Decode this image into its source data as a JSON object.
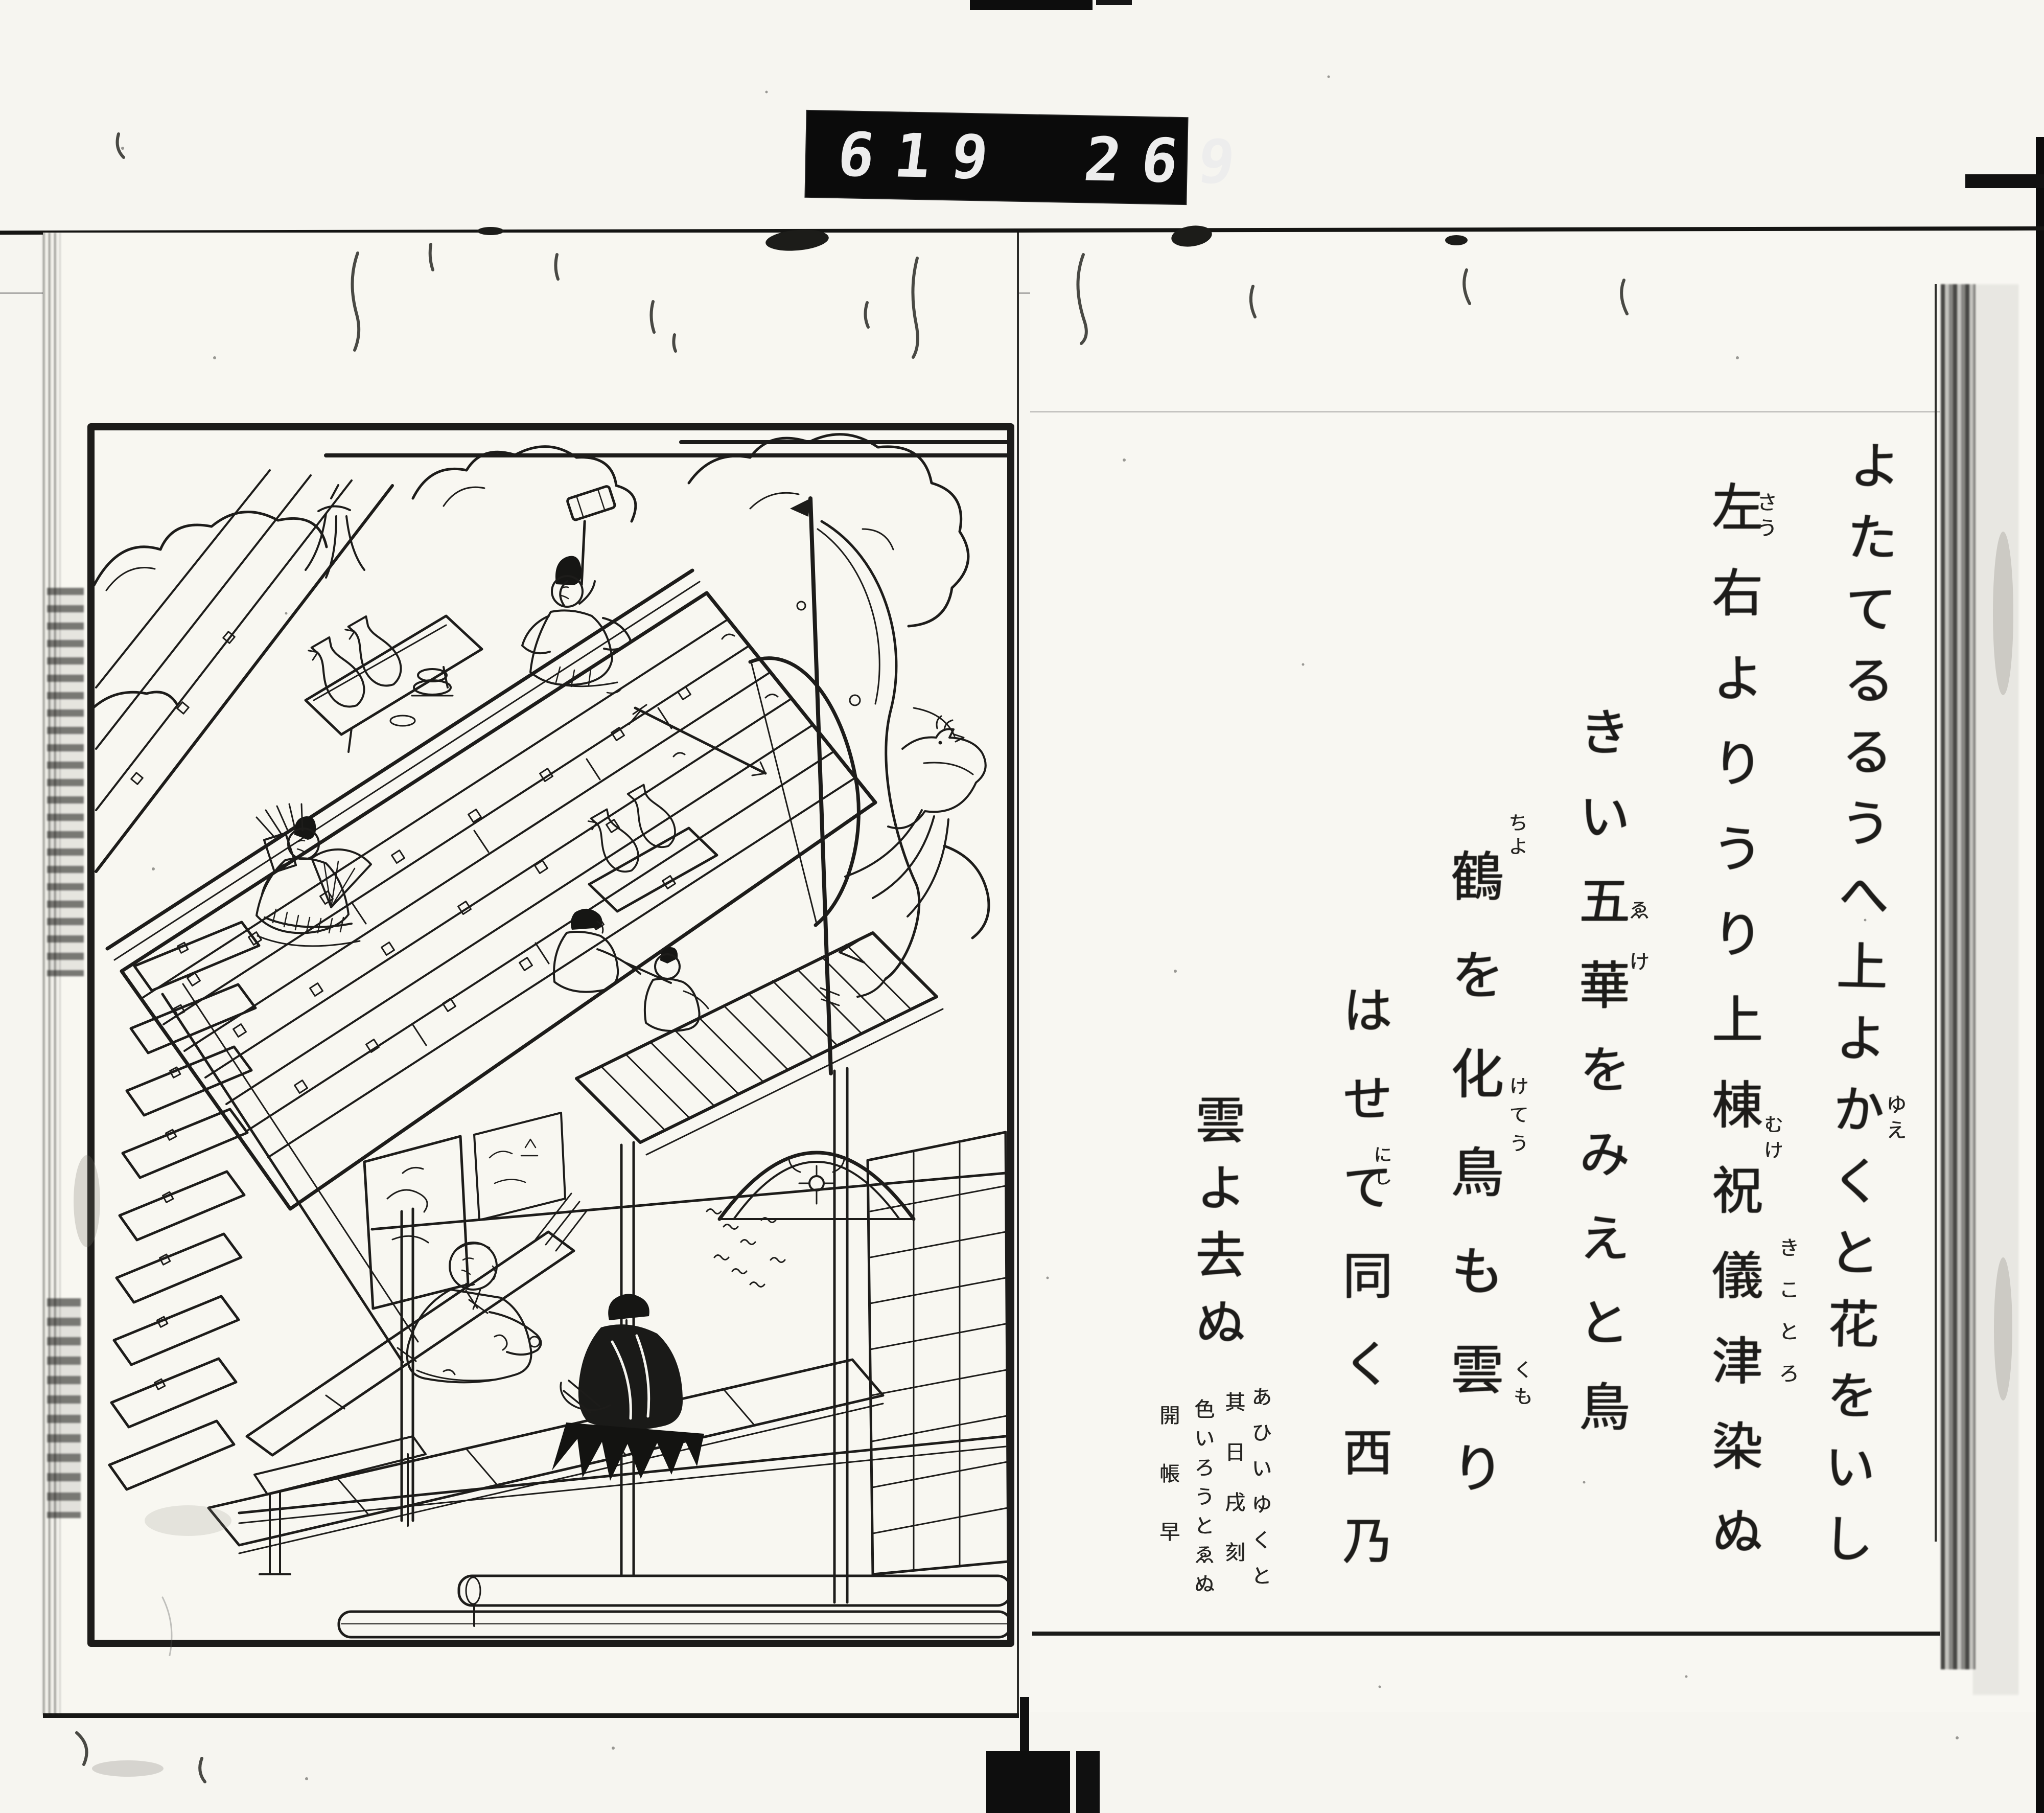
{
  "counter": {
    "group1": "619",
    "group2": "269",
    "dot": "."
  },
  "right_page": {
    "columns": [
      {
        "text": "よたてるるうへ上よかくと花をいし"
      },
      {
        "text": "左右よりうり上棟祝儀津染ぬ"
      },
      {
        "text": "きい五華をみえと鳥"
      },
      {
        "text": "鶴を化鳥も雲り"
      },
      {
        "text": "はせて同く西乃"
      },
      {
        "text": "雲よ去ぬ"
      }
    ],
    "furigana": [
      {
        "text": "ゆえ"
      },
      {
        "text": "さう"
      },
      {
        "text": "きことろ"
      },
      {
        "text": "ゑけ"
      },
      {
        "text": "ちよ"
      },
      {
        "text": "けてう"
      },
      {
        "text": "くも"
      },
      {
        "text": "にし"
      },
      {
        "text": "むけ"
      }
    ],
    "annotations": [
      {
        "text": "あひいゆくと"
      },
      {
        "text": "其日戌刻"
      },
      {
        "text": "色いろうとゑぬ"
      },
      {
        "text": "開帳早"
      }
    ]
  },
  "illustration": {
    "elements": [
      "roof-construction",
      "ridge-beam",
      "mallet-figure",
      "archer-figure",
      "carpenter-figures",
      "sake-bottle-table",
      "banner-bow-streamer",
      "ceremonial-arrow",
      "phoenix-bird",
      "clouds",
      "gable-ornament",
      "lumber-stairs",
      "veranda-deck",
      "interior-monk",
      "interior-attendant",
      "stacked-logs",
      "small-birds",
      "folding-screen"
    ]
  },
  "colors": {
    "ink": "#1d1c1a",
    "paper": "#f7f5ef",
    "counter_bg": "#0b0b0b",
    "counter_digits": "#ededed"
  }
}
